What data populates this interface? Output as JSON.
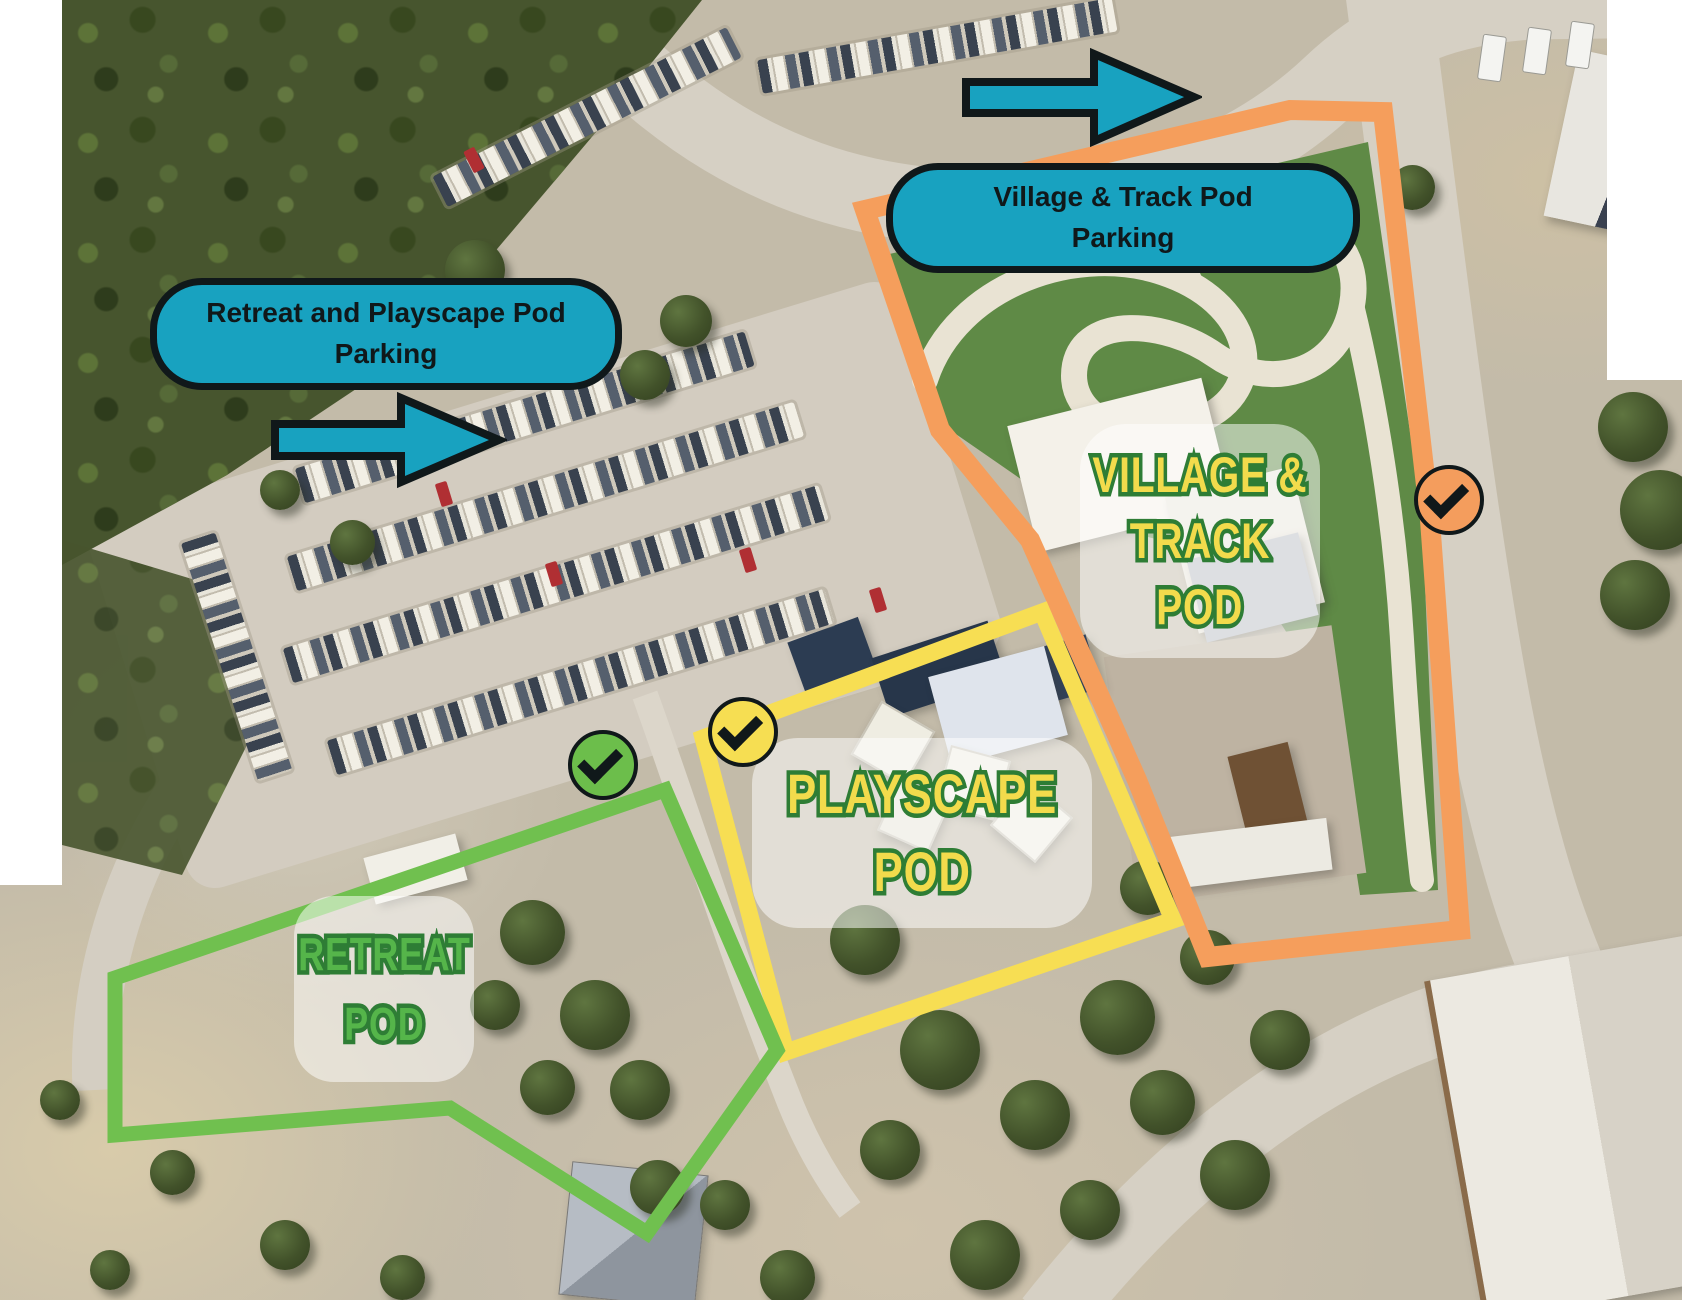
{
  "callouts": [
    {
      "id": "retreat-playscape-parking",
      "lines": [
        "Retreat and Playscape Pod",
        "Parking"
      ],
      "fill": "#18A2C0",
      "border": "#10181A"
    },
    {
      "id": "village-track-parking",
      "lines": [
        "Village & Track Pod",
        "Parking"
      ],
      "fill": "#18A2C0",
      "border": "#10181A"
    }
  ],
  "arrows": [
    {
      "id": "retreat-playscape-direction",
      "direction": "right",
      "fill": "#18A2C0"
    },
    {
      "id": "village-track-direction",
      "direction": "right",
      "fill": "#18A2C0"
    }
  ],
  "pods": {
    "village_track": {
      "lines": [
        "VILLAGE &",
        "TRACK",
        "POD"
      ],
      "text_color": "#F2DB4C",
      "outline_color": "#2E7D35"
    },
    "playscape": {
      "lines": [
        "PLAYSCAPE",
        "POD"
      ],
      "text_color": "#F2DB4C",
      "outline_color": "#2E7D35"
    },
    "retreat": {
      "lines": [
        "RETREAT",
        "POD"
      ],
      "text_color": "#55B54A",
      "outline_color": "#2E7D35"
    }
  },
  "outlines": {
    "retreat": {
      "area": "Retreat Pod",
      "color": "#70C04F"
    },
    "playscape": {
      "area": "Playscape Pod",
      "color": "#F7DE53"
    },
    "village_track": {
      "area": "Village & Track Pod",
      "color": "#F59E5C"
    }
  },
  "checkmarks": [
    {
      "area": "Retreat Pod",
      "fill": "#6CBE4B",
      "icon": "check-icon",
      "glyph": "✔"
    },
    {
      "area": "Playscape Pod",
      "fill": "#F6DE52",
      "icon": "check-icon",
      "glyph": "✔"
    },
    {
      "area": "Village & Track Pod",
      "fill": "#F49D5D",
      "icon": "check-icon",
      "glyph": "✔"
    }
  ]
}
